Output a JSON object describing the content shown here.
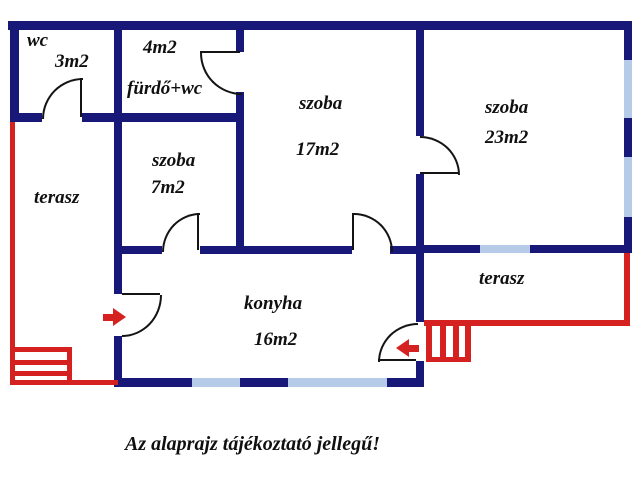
{
  "colors": {
    "wall": "#181878",
    "window": "#b5cbe8",
    "accent_red": "#d62121",
    "text": "#101010",
    "background": "#ffffff"
  },
  "rooms": [
    {
      "name": "wc",
      "label": "wc",
      "area": "3m2"
    },
    {
      "name": "furdo-wc",
      "label": "fürdő+wc",
      "area": "4m2"
    },
    {
      "name": "szoba-7",
      "label": "szoba",
      "area": "7m2"
    },
    {
      "name": "szoba-17",
      "label": "szoba",
      "area": "17m2"
    },
    {
      "name": "szoba-23",
      "label": "szoba",
      "area": "23m2"
    },
    {
      "name": "konyha",
      "label": "konyha",
      "area": "16m2"
    },
    {
      "name": "terasz-left",
      "label": "terasz",
      "area": ""
    },
    {
      "name": "terasz-right",
      "label": "terasz",
      "area": ""
    }
  ],
  "disclaimer": "Az alaprajz tájékoztató jellegű!"
}
